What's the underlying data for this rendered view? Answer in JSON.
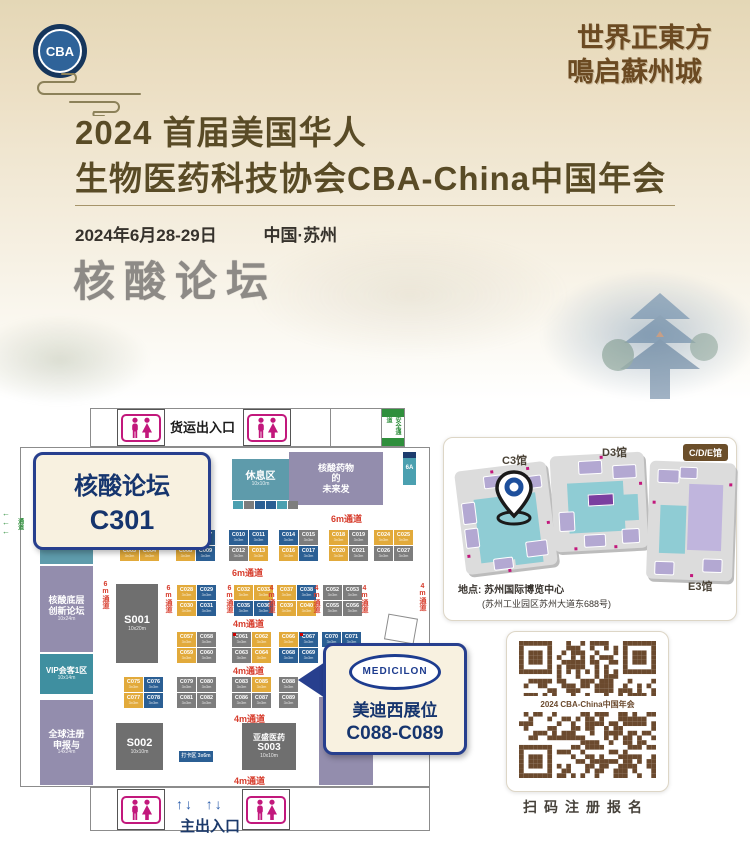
{
  "header": {
    "logo_text": "CBA",
    "calligraphy_line1": "世界正東方",
    "calligraphy_line2": "鳴启蘇州城",
    "title_line1": "2024 首届美国华人",
    "title_line2": "生物医药科技协会CBA-China中国年会",
    "date": "2024年6月28-29日",
    "location": "中国·苏州",
    "forum_title": "核酸论坛"
  },
  "palette": {
    "y": "#e2aa3b",
    "b": "#2b5f94",
    "g": "#7d7d7d",
    "t": "#4ba0b0",
    "room_purple": "#938dad",
    "room_teal": "#5e9bab",
    "room_teal_dark": "#3f8fa0",
    "room_dark": "#6f6f6f",
    "aisle_red": "#d73c2c",
    "wc_pink": "#c2187c",
    "qr_brown": "#6b4a2e",
    "green": "#2f8f3c"
  },
  "floorplan": {
    "freight_entrance": "货运出入口",
    "safety_passage": "安全通道",
    "main_entrance": "主出入口",
    "side_passage": "通道",
    "booth_size_note": "3x3m",
    "callout_forum": {
      "line1": "核酸论坛",
      "line2": "C301"
    },
    "callout_medicilon": {
      "logo": "MEDICILON",
      "line1": "美迪西展位",
      "line2": "C088-C089"
    },
    "rooms": [
      {
        "name": "room-zhongshan-c306",
        "x": 117,
        "y": 57,
        "w": 79,
        "h": 37,
        "bg": "room_purple",
        "lines": [
          {
            "t": "中山大学 A联合体",
            "fs": 7
          },
          {
            "t": "C306  16x10m",
            "fs": 8,
            "b": true
          }
        ]
      },
      {
        "name": "room-rest-area",
        "x": 222,
        "y": 61,
        "w": 57,
        "h": 41,
        "bg": "room_teal",
        "lines": [
          {
            "t": "休息区",
            "fs": 10,
            "b": true
          },
          {
            "t": "10x10m",
            "fs": 5
          }
        ]
      },
      {
        "name": "room-nucleic-future",
        "x": 279,
        "y": 54,
        "w": 94,
        "h": 53,
        "bg": "room_purple",
        "lines": [
          {
            "t": "核酸药物",
            "fs": 9,
            "b": true
          },
          {
            "t": "的",
            "fs": 9,
            "b": true
          },
          {
            "t": "未来发",
            "fs": 9,
            "b": true
          }
        ]
      },
      {
        "name": "room-6a",
        "x": 393,
        "y": 54,
        "w": 13,
        "h": 33,
        "bg": "t",
        "cap": true,
        "lines": [
          {
            "t": "6A",
            "fs": 6,
            "b": true
          }
        ]
      },
      {
        "name": "room-meeting-zone1",
        "x": 30,
        "y": 124,
        "w": 53,
        "h": 42,
        "bg": "room_teal",
        "lines": [
          {
            "t": "会客1区",
            "fs": 9,
            "b": true
          },
          {
            "t": "10x14m",
            "fs": 5
          }
        ]
      },
      {
        "name": "room-nucleic-forum",
        "x": 30,
        "y": 168,
        "w": 53,
        "h": 86,
        "bg": "room_purple",
        "lines": [
          {
            "t": "核酸底层",
            "fs": 9,
            "b": true
          },
          {
            "t": "创新论坛",
            "fs": 9,
            "b": true
          },
          {
            "t": "10x24m",
            "fs": 5
          }
        ]
      },
      {
        "name": "room-vip-meeting1",
        "x": 30,
        "y": 256,
        "w": 53,
        "h": 40,
        "bg": "room_teal_dark",
        "lines": [
          {
            "t": "VIP会客1区",
            "fs": 8,
            "b": true
          },
          {
            "t": "10x14m",
            "fs": 5
          }
        ]
      },
      {
        "name": "room-global-registration",
        "x": 30,
        "y": 302,
        "w": 53,
        "h": 85,
        "bg": "room_purple",
        "lines": [
          {
            "t": "全球注册",
            "fs": 9,
            "b": true
          },
          {
            "t": "申报与",
            "fs": 9,
            "b": true
          },
          {
            "t": "14x24m",
            "fs": 5
          }
        ]
      },
      {
        "name": "room-s001",
        "x": 106,
        "y": 186,
        "w": 42,
        "h": 79,
        "bg": "room_dark",
        "lines": [
          {
            "t": "S001",
            "fs": 11,
            "b": true
          },
          {
            "t": "10x20m",
            "fs": 5
          }
        ]
      },
      {
        "name": "room-s002",
        "x": 106,
        "y": 325,
        "w": 47,
        "h": 47,
        "bg": "room_dark",
        "lines": [
          {
            "t": "S002",
            "fs": 11,
            "b": true
          },
          {
            "t": "10x10m",
            "fs": 5
          }
        ]
      },
      {
        "name": "room-s003-yasheng",
        "x": 232,
        "y": 325,
        "w": 54,
        "h": 47,
        "bg": "room_dark",
        "lines": [
          {
            "t": "亚盛医药",
            "fs": 8,
            "b": true
          },
          {
            "t": "S003",
            "fs": 10,
            "b": true
          },
          {
            "t": "10x10m",
            "fs": 5
          }
        ]
      },
      {
        "name": "room-checkin",
        "x": 169,
        "y": 353,
        "w": 34,
        "h": 11,
        "bg": "b",
        "lines": [
          {
            "t": "打卡区 3x6m",
            "fs": 5,
            "b": true
          }
        ]
      },
      {
        "name": "room-right-purple",
        "x": 309,
        "y": 299,
        "w": 54,
        "h": 88,
        "bg": "room_purple",
        "lines": [
          {
            "t": " ",
            "fs": 8
          },
          {
            "t": "14x24m",
            "fs": 5
          }
        ]
      }
    ],
    "strips": [
      {
        "x": 118,
        "y": 95,
        "cells": [
          "t",
          "g",
          "b",
          "g",
          "g",
          "b",
          "t"
        ]
      },
      {
        "x": 223,
        "y": 103,
        "cells": [
          "t",
          "g",
          "b",
          "b",
          "t",
          "g"
        ]
      }
    ],
    "clusters": [
      {
        "x": 110,
        "y": 132,
        "cols": 2,
        "booths": [
          {
            "l": "C001",
            "c": "y"
          },
          {
            "l": "C002",
            "c": "g"
          },
          {
            "l": "C003",
            "c": "y"
          },
          {
            "l": "C004",
            "c": "y"
          }
        ]
      },
      {
        "x": 166,
        "y": 132,
        "cols": 2,
        "booths": [
          {
            "l": "C006",
            "c": "g"
          },
          {
            "l": "C007",
            "c": "b"
          },
          {
            "l": "C008",
            "c": "y"
          },
          {
            "l": "C009",
            "c": "b"
          }
        ]
      },
      {
        "x": 219,
        "y": 132,
        "cols": 2,
        "booths": [
          {
            "l": "C010",
            "c": "b"
          },
          {
            "l": "C011",
            "c": "b"
          },
          {
            "l": "C012",
            "c": "g"
          },
          {
            "l": "C013",
            "c": "y"
          }
        ]
      },
      {
        "x": 269,
        "y": 132,
        "cols": 2,
        "booths": [
          {
            "l": "C014",
            "c": "b"
          },
          {
            "l": "C015",
            "c": "g"
          },
          {
            "l": "C016",
            "c": "y"
          },
          {
            "l": "C017",
            "c": "b"
          }
        ]
      },
      {
        "x": 319,
        "y": 132,
        "cols": 2,
        "booths": [
          {
            "l": "C018",
            "c": "y"
          },
          {
            "l": "C019",
            "c": "g"
          },
          {
            "l": "C020",
            "c": "y"
          },
          {
            "l": "C021",
            "c": "g"
          }
        ]
      },
      {
        "x": 364,
        "y": 132,
        "cols": 2,
        "booths": [
          {
            "l": "C024",
            "c": "y"
          },
          {
            "l": "C025",
            "c": "y"
          },
          {
            "l": "C026",
            "c": "g"
          },
          {
            "l": "C027",
            "c": "g"
          }
        ]
      },
      {
        "x": 167,
        "y": 187,
        "cols": 2,
        "booths": [
          {
            "l": "C028",
            "c": "y"
          },
          {
            "l": "C029",
            "c": "b"
          },
          {
            "l": "C030",
            "c": "y"
          },
          {
            "l": "C031",
            "c": "b"
          }
        ]
      },
      {
        "x": 224,
        "y": 187,
        "cols": 2,
        "booths": [
          {
            "l": "C032",
            "c": "y"
          },
          {
            "l": "C033",
            "c": "y"
          },
          {
            "l": "C035",
            "c": "b"
          },
          {
            "l": "C036",
            "c": "b"
          }
        ]
      },
      {
        "x": 267,
        "y": 187,
        "cols": 2,
        "booths": [
          {
            "l": "C037",
            "c": "y"
          },
          {
            "l": "C038",
            "c": "b"
          },
          {
            "l": "C039",
            "c": "y"
          },
          {
            "l": "C040",
            "c": "y"
          }
        ]
      },
      {
        "x": 313,
        "y": 187,
        "cols": 2,
        "booths": [
          {
            "l": "C052",
            "c": "g"
          },
          {
            "l": "C053",
            "c": "g"
          },
          {
            "l": "C055",
            "c": "g"
          },
          {
            "l": "C056",
            "c": "g"
          }
        ]
      },
      {
        "x": 167,
        "y": 234,
        "cols": 2,
        "booths": [
          {
            "l": "C057",
            "c": "y"
          },
          {
            "l": "C058",
            "c": "g"
          },
          {
            "l": "C059",
            "c": "y"
          },
          {
            "l": "C060",
            "c": "g"
          }
        ]
      },
      {
        "x": 222,
        "y": 234,
        "cols": 2,
        "booths": [
          {
            "l": "C061",
            "c": "g",
            "dot": true
          },
          {
            "l": "C062",
            "c": "y"
          },
          {
            "l": "C063",
            "c": "g"
          },
          {
            "l": "C064",
            "c": "y"
          }
        ]
      },
      {
        "x": 269,
        "y": 234,
        "cols": 2,
        "booths": [
          {
            "l": "C066",
            "c": "y"
          },
          {
            "l": "C067",
            "c": "b",
            "dot": true
          },
          {
            "l": "C068",
            "c": "b"
          },
          {
            "l": "C069",
            "c": "b"
          }
        ]
      },
      {
        "x": 312,
        "y": 234,
        "cols": 2,
        "booths": [
          {
            "l": "C070",
            "c": "b"
          },
          {
            "l": "C071",
            "c": "b"
          }
        ]
      },
      {
        "x": 114,
        "y": 279,
        "cols": 2,
        "booths": [
          {
            "l": "C075",
            "c": "y"
          },
          {
            "l": "C076",
            "c": "b"
          },
          {
            "l": "C077",
            "c": "y"
          },
          {
            "l": "C078",
            "c": "b"
          }
        ]
      },
      {
        "x": 167,
        "y": 279,
        "cols": 2,
        "booths": [
          {
            "l": "C079",
            "c": "g"
          },
          {
            "l": "C080",
            "c": "g"
          },
          {
            "l": "C081",
            "c": "g"
          },
          {
            "l": "C082",
            "c": "g"
          }
        ]
      },
      {
        "x": 222,
        "y": 279,
        "cols": 2,
        "booths": [
          {
            "l": "C083",
            "c": "g"
          },
          {
            "l": "C085",
            "c": "y"
          },
          {
            "l": "C086",
            "c": "g"
          },
          {
            "l": "C087",
            "c": "g"
          }
        ]
      },
      {
        "x": 269,
        "y": 279,
        "cols": 1,
        "booths": [
          {
            "l": "C088",
            "c": "g"
          },
          {
            "l": "C089",
            "c": "g"
          }
        ]
      }
    ],
    "aisles_h": [
      {
        "t": "6m通道",
        "x": 321,
        "y": 114
      },
      {
        "t": "6m通道",
        "x": 222,
        "y": 168
      },
      {
        "t": "4m通道",
        "x": 223,
        "y": 219
      },
      {
        "t": "4m通道",
        "x": 223,
        "y": 266
      },
      {
        "t": "4m通道",
        "x": 224,
        "y": 314
      },
      {
        "t": "4m通道",
        "x": 224,
        "y": 376
      }
    ],
    "aisles_v": [
      {
        "t": "6m通道",
        "x": 90,
        "y": 183
      },
      {
        "t": "6m通道",
        "x": 153,
        "y": 187
      },
      {
        "t": "6m通道",
        "x": 214,
        "y": 187
      },
      {
        "t": "4m通道",
        "x": 256,
        "y": 187
      },
      {
        "t": "4m通道",
        "x": 301,
        "y": 187
      },
      {
        "t": "4m通道",
        "x": 349,
        "y": 187
      },
      {
        "t": "4m通道",
        "x": 407,
        "y": 185
      }
    ]
  },
  "venue": {
    "tag": "C/D/E馆",
    "halls": [
      {
        "label": "C3馆"
      },
      {
        "label": "D3馆"
      },
      {
        "label": "E3馆"
      }
    ],
    "address_line1": "地点: 苏州国际博览中心",
    "address_line2": "(苏州工业园区苏州大道东688号)"
  },
  "qr": {
    "center_label": "2024 CBA-China中国年会",
    "caption": "扫码注册报名"
  }
}
